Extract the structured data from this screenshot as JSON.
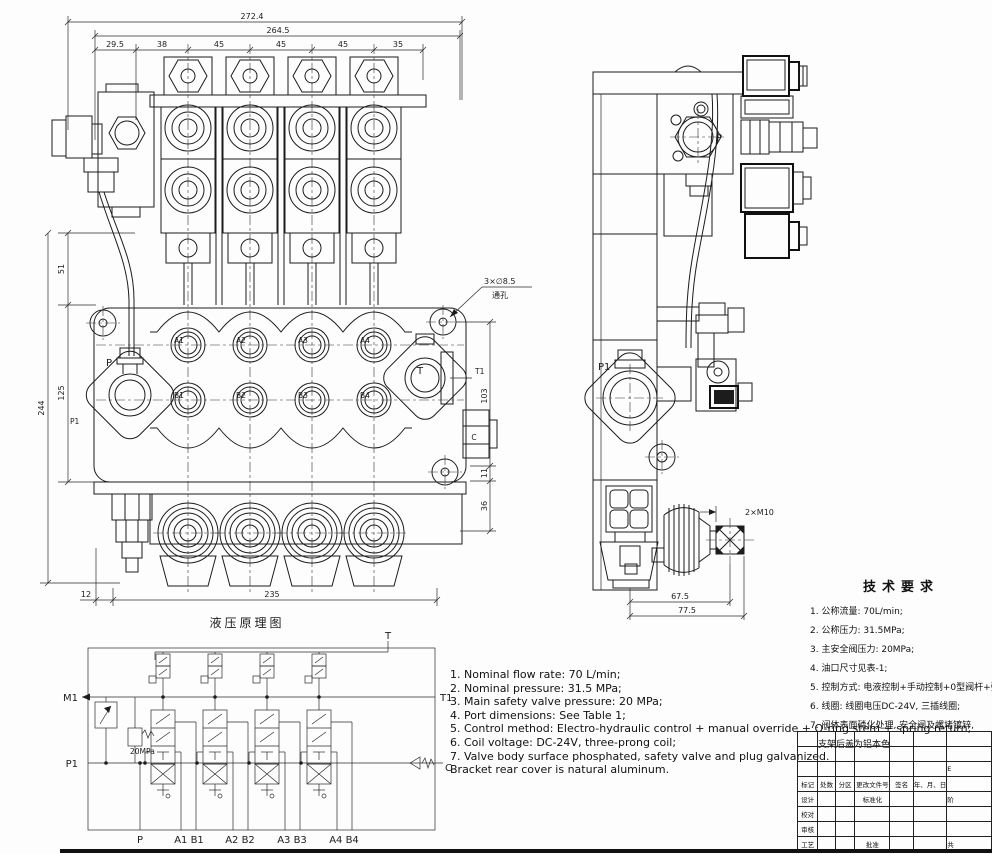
{
  "front_view": {
    "dim_overall": "272.4",
    "dim_inner": "264.5",
    "seg_dims": [
      "29.5",
      "38",
      "45",
      "45",
      "45",
      "35"
    ],
    "dim_51": "51",
    "dim_125": "125",
    "dim_244": "244",
    "dim_12": "12",
    "dim_235": "235",
    "dim_103": "103",
    "dim_11": "11",
    "dim_36": "36",
    "hole_note_line1": "3×∅8.5",
    "hole_note_line2": "通孔",
    "port_a": [
      "A1",
      "A2",
      "A3",
      "A4"
    ],
    "port_b": [
      "B1",
      "B2",
      "B3",
      "B4"
    ],
    "label_p": "P",
    "label_p1": "P1",
    "label_t": "T",
    "label_t1": "T1",
    "label_c": "C"
  },
  "side_view": {
    "label_p": "P",
    "label_p1": "P1",
    "note_m10": "2×M10",
    "dim_675": "67.5",
    "dim_775": "77.5"
  },
  "schematic": {
    "title": "液压原理图",
    "label_t": "T",
    "label_t1": "T1",
    "label_m1": "M1",
    "label_p1": "P1",
    "label_c": "C",
    "label_pressure": "20MPa",
    "bottom_labels": [
      "P",
      "A1 B1",
      "A2 B2",
      "A3 B3",
      "A4 B4"
    ]
  },
  "tech_requirements": {
    "heading": "技术要求",
    "items": [
      "1. 公称流量: 70L/min;",
      "2. 公称压力: 31.5MPa;",
      "3. 主安全阀压力: 20MPa;",
      "4. 油口尺寸见表-1;",
      "5. 控制方式: 电液控制+手动控制+0型阀杆+弹簧复位;",
      "6. 线圈: 线圈电压DC-24V, 三插线圈;",
      "7. 阀体表面磷化处理, 安全阀及螺堵镀锌,",
      "支架后盖为铝本色."
    ]
  },
  "notes_en": {
    "items": [
      "1. Nominal flow rate: 70 L/min;",
      "2. Nominal pressure: 31.5 MPa;",
      "3. Main safety valve pressure: 20 MPa;",
      "4. Port dimensions: See Table 1;",
      "5. Control method: Electro-hydraulic control + manual override + O-ring stem + spring return;",
      "6. Coil voltage: DC-24V, three-prong coil;",
      "7. Valve body surface phosphated, safety valve and plug galvanized.",
      "Bracket rear cover is natural aluminum."
    ]
  },
  "title_block": {
    "header_row": [
      "标记",
      "处数",
      "分区",
      "更改文件号",
      "签名",
      "年、月、日"
    ],
    "row_design": "设计",
    "row_check": "校对",
    "row_review": "审核",
    "row_process": "工艺",
    "label_standardization": "标准化",
    "label_approve": "批准",
    "partial_code": "E",
    "partial_stage": "阶",
    "partial_sheets": "共"
  }
}
